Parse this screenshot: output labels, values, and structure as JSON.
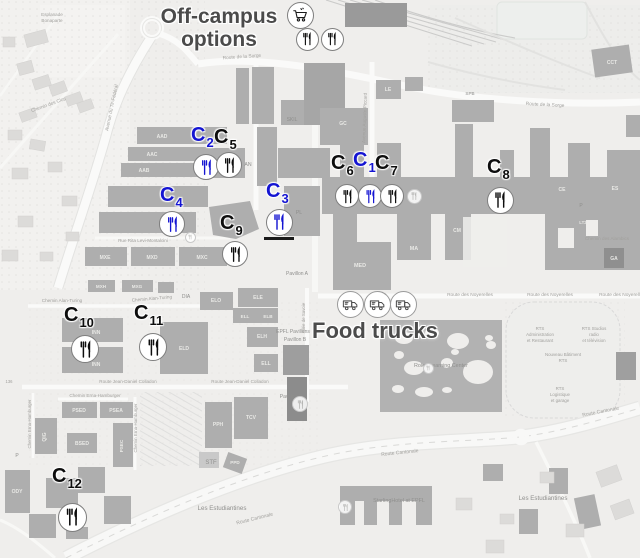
{
  "figure": {
    "off_campus": {
      "line1": "Off-campus",
      "line2": "options"
    },
    "food_trucks_label": "Food trucks",
    "colors": {
      "blue": "#1414d2",
      "black": "#0d0d0d",
      "heading": "#4b4b4b"
    },
    "c_markers": [
      {
        "label": "C",
        "sub": "1",
        "color": "blue",
        "lx": 353,
        "ly": 150,
        "cx": 370,
        "cy": 196,
        "d": 24
      },
      {
        "label": "C",
        "sub": "2",
        "color": "blue",
        "lx": 191,
        "ly": 125,
        "cx": 206,
        "cy": 167,
        "d": 26
      },
      {
        "label": "C",
        "sub": "3",
        "color": "blue",
        "lx": 266,
        "ly": 181,
        "cx": 279,
        "cy": 222,
        "d": 27,
        "underline": true
      },
      {
        "label": "C",
        "sub": "4",
        "color": "blue",
        "lx": 160,
        "ly": 185,
        "cx": 172,
        "cy": 224,
        "d": 26
      },
      {
        "label": "C",
        "sub": "5",
        "color": "black",
        "lx": 214,
        "ly": 127,
        "cx": 229,
        "cy": 165,
        "d": 26
      },
      {
        "label": "C",
        "sub": "6",
        "color": "black",
        "lx": 331,
        "ly": 153,
        "cx": 347,
        "cy": 196,
        "d": 24
      },
      {
        "label": "C",
        "sub": "7",
        "color": "black",
        "lx": 375,
        "ly": 153,
        "cx": 392,
        "cy": 196,
        "d": 24
      },
      {
        "label": "C",
        "sub": "8",
        "color": "black",
        "lx": 487,
        "ly": 157,
        "cx": 500,
        "cy": 200,
        "d": 27
      },
      {
        "label": "C",
        "sub": "9",
        "color": "black",
        "lx": 220,
        "ly": 213,
        "cx": 235,
        "cy": 254,
        "d": 26
      },
      {
        "label": "C",
        "sub": "10",
        "color": "black",
        "lx": 64,
        "ly": 305,
        "cx": 85,
        "cy": 349,
        "d": 28
      },
      {
        "label": "C",
        "sub": "11",
        "color": "black",
        "lx": 134,
        "ly": 303,
        "cx": 153,
        "cy": 347,
        "d": 28
      },
      {
        "label": "C",
        "sub": "12",
        "color": "black",
        "lx": 52,
        "ly": 466,
        "cx": 72,
        "cy": 517,
        "d": 29
      }
    ],
    "off_campus_markers": {
      "cart": {
        "x": 300,
        "y": 15,
        "d": 27
      },
      "forks": [
        {
          "x": 307,
          "y": 39,
          "d": 23
        },
        {
          "x": 332,
          "y": 39,
          "d": 23
        }
      ]
    },
    "food_trucks": [
      {
        "x": 350,
        "y": 304,
        "d": 27
      },
      {
        "x": 377,
        "y": 304,
        "d": 27
      },
      {
        "x": 403,
        "y": 304,
        "d": 27
      }
    ],
    "faint_pois": [
      {
        "x": 414,
        "y": 196,
        "d": 15
      },
      {
        "x": 300,
        "y": 404,
        "d": 16
      },
      {
        "x": 345,
        "y": 507,
        "d": 14
      },
      {
        "x": 428,
        "y": 368,
        "d": 11
      },
      {
        "x": 190,
        "y": 237,
        "d": 11
      }
    ],
    "map_labels": [
      {
        "t": "Esplanade",
        "x": 52,
        "y": 16,
        "s": 4.6,
        "c": "road"
      },
      {
        "t": "Bonaparte",
        "x": 52,
        "y": 22,
        "s": 4.6,
        "c": "road"
      },
      {
        "t": "Chemin des Clos",
        "x": 49,
        "y": 106,
        "s": 4.8,
        "c": "road",
        "r": -20
      },
      {
        "t": "Avenue du Tir-Fédéral",
        "x": 113,
        "y": 108,
        "s": 4.8,
        "c": "road",
        "r": -78
      },
      {
        "t": "Route de la Sorge",
        "x": 242,
        "y": 58,
        "s": 4.8,
        "c": "road",
        "r": -4
      },
      {
        "t": "Route de la Sorge",
        "x": 545,
        "y": 106,
        "s": 4.8,
        "c": "road",
        "r": 3
      },
      {
        "t": "Avenue Auguste-Piccard",
        "x": 366,
        "y": 118,
        "s": 4.6,
        "c": "road",
        "r": -88
      },
      {
        "t": "Rue Rita Levi-Montalcini",
        "x": 143,
        "y": 242,
        "s": 4.6,
        "c": "road"
      },
      {
        "t": "Chemin Alan-Turing",
        "x": 62,
        "y": 302,
        "s": 4.6,
        "c": "road"
      },
      {
        "t": "Chemin Alan-Turing",
        "x": 152,
        "y": 300,
        "s": 4.6,
        "c": "road",
        "r": -5
      },
      {
        "t": "Route Jean-Daniel Colladon",
        "x": 128,
        "y": 383,
        "s": 4.6,
        "c": "road"
      },
      {
        "t": "Route Jean-Daniel Colladon",
        "x": 240,
        "y": 383,
        "s": 4.6,
        "c": "road"
      },
      {
        "t": "Chemin Erna-Hamburger",
        "x": 95,
        "y": 397,
        "s": 4.6,
        "c": "road"
      },
      {
        "t": "Chemin Erna-Hamburger",
        "x": 31,
        "y": 424,
        "s": 4.4,
        "c": "road",
        "r": -90
      },
      {
        "t": "Chemin Erna-Hamburger",
        "x": 137,
        "y": 428,
        "s": 4.4,
        "c": "road",
        "r": -90
      },
      {
        "t": "Allée de Savoie",
        "x": 305,
        "y": 318,
        "s": 4.4,
        "c": "road",
        "r": -90
      },
      {
        "t": "Route des Noyerelles",
        "x": 470,
        "y": 296,
        "s": 4.8,
        "c": "road"
      },
      {
        "t": "Route des Noyerelles",
        "x": 550,
        "y": 296,
        "s": 4.8,
        "c": "road"
      },
      {
        "t": "Route des Noyerelles",
        "x": 622,
        "y": 296,
        "s": 4.8,
        "c": "road"
      },
      {
        "t": "Route Cantonale",
        "x": 255,
        "y": 520,
        "s": 5,
        "c": "road",
        "r": -14
      },
      {
        "t": "Route Cantonale",
        "x": 400,
        "y": 454,
        "s": 5,
        "c": "road",
        "r": -6
      },
      {
        "t": "Route Cantonale",
        "x": 601,
        "y": 413,
        "s": 5,
        "c": "road",
        "r": -11
      },
      {
        "t": "Chemin des Alambics",
        "x": 607,
        "y": 240,
        "s": 4.6,
        "c": "road"
      },
      {
        "t": "Les Estudiantines",
        "x": 222,
        "y": 510,
        "s": 6.2,
        "c": "dark"
      },
      {
        "t": "Les Estudiantines",
        "x": 543,
        "y": 500,
        "s": 6.2,
        "c": "dark"
      },
      {
        "t": "StarlingHotel at EPFL",
        "x": 399,
        "y": 502,
        "s": 5.4,
        "c": "dark"
      },
      {
        "t": "Rolex Learning Center",
        "x": 441,
        "y": 367,
        "s": 5.4,
        "c": "dark"
      },
      {
        "t": "EPFL Pavilions",
        "x": 293,
        "y": 333,
        "s": 5,
        "c": "dark"
      },
      {
        "t": "Pavillon B",
        "x": 295,
        "y": 341,
        "s": 5,
        "c": "dark"
      },
      {
        "t": "Pavillon A",
        "x": 297,
        "y": 275,
        "s": 5,
        "c": "dark"
      },
      {
        "t": "Pavillon C",
        "x": 291,
        "y": 398,
        "s": 5,
        "c": "dark"
      },
      {
        "t": "DIA",
        "x": 186,
        "y": 298,
        "s": 5,
        "c": "dark"
      },
      {
        "t": "STF",
        "x": 211,
        "y": 464,
        "s": 6,
        "c": "dark"
      },
      {
        "t": "SKIL",
        "x": 292,
        "y": 121,
        "s": 5,
        "c": "dark"
      },
      {
        "t": "AN",
        "x": 248,
        "y": 166,
        "s": 5.2,
        "c": "dark"
      },
      {
        "t": "PL",
        "x": 299,
        "y": 214,
        "s": 5.2,
        "c": "dark"
      },
      {
        "t": "SPB",
        "x": 470,
        "y": 95,
        "s": 4.6,
        "c": "dark"
      },
      {
        "t": "P",
        "x": 17,
        "y": 457,
        "s": 5,
        "c": "dark"
      },
      {
        "t": "P",
        "x": 581,
        "y": 207,
        "s": 5,
        "c": "dark"
      },
      {
        "t": "136",
        "x": 9,
        "y": 383,
        "s": 4.2,
        "c": "road"
      },
      {
        "t": "AAD",
        "x": 162,
        "y": 138,
        "s": 5,
        "c": "bldg"
      },
      {
        "t": "AAC",
        "x": 152,
        "y": 156,
        "s": 5,
        "c": "bldg"
      },
      {
        "t": "AAB",
        "x": 144,
        "y": 172,
        "s": 5,
        "c": "bldg"
      },
      {
        "t": "MXE",
        "x": 105,
        "y": 259,
        "s": 5,
        "c": "bldg"
      },
      {
        "t": "MXD",
        "x": 152,
        "y": 259,
        "s": 5,
        "c": "bldg"
      },
      {
        "t": "MXC",
        "x": 202,
        "y": 259,
        "s": 5,
        "c": "bldg"
      },
      {
        "t": "MXH",
        "x": 101,
        "y": 288,
        "s": 4.6,
        "c": "bldg"
      },
      {
        "t": "MXG",
        "x": 137,
        "y": 288,
        "s": 4.6,
        "c": "bldg"
      },
      {
        "t": "INN",
        "x": 96,
        "y": 334,
        "s": 5,
        "c": "bldg"
      },
      {
        "t": "INN",
        "x": 96,
        "y": 366,
        "s": 5,
        "c": "bldg"
      },
      {
        "t": "ELD",
        "x": 184,
        "y": 350,
        "s": 5,
        "c": "bldg"
      },
      {
        "t": "ELO",
        "x": 216,
        "y": 302,
        "s": 5,
        "c": "bldg"
      },
      {
        "t": "ELE",
        "x": 258,
        "y": 299,
        "s": 5,
        "c": "bldg"
      },
      {
        "t": "ELL",
        "x": 245,
        "y": 318,
        "s": 4.6,
        "c": "bldg"
      },
      {
        "t": "ELB",
        "x": 268,
        "y": 318,
        "s": 4.6,
        "c": "bldg"
      },
      {
        "t": "ELH",
        "x": 262,
        "y": 338,
        "s": 5,
        "c": "bldg"
      },
      {
        "t": "ELL",
        "x": 266,
        "y": 365,
        "s": 5,
        "c": "bldg"
      },
      {
        "t": "MED",
        "x": 360,
        "y": 267,
        "s": 5.4,
        "c": "bldg"
      },
      {
        "t": "MA",
        "x": 414,
        "y": 250,
        "s": 5.4,
        "c": "bldg"
      },
      {
        "t": "CE",
        "x": 562,
        "y": 191,
        "s": 5,
        "c": "bldg"
      },
      {
        "t": "ES",
        "x": 615,
        "y": 190,
        "s": 5,
        "c": "bldg"
      },
      {
        "t": "GA",
        "x": 614,
        "y": 260,
        "s": 5,
        "c": "bldg"
      },
      {
        "t": "CM",
        "x": 457,
        "y": 232,
        "s": 5,
        "c": "bldg"
      },
      {
        "t": "GC",
        "x": 343,
        "y": 125,
        "s": 5,
        "c": "bldg"
      },
      {
        "t": "LE",
        "x": 388,
        "y": 91,
        "s": 5,
        "c": "bldg"
      },
      {
        "t": "CCT",
        "x": 612,
        "y": 64,
        "s": 5,
        "c": "bldg"
      },
      {
        "t": "QIG",
        "x": 46,
        "y": 437,
        "s": 5,
        "c": "bldg",
        "r": -90
      },
      {
        "t": "PSED",
        "x": 79,
        "y": 412,
        "s": 5,
        "c": "bldg"
      },
      {
        "t": "PSEA",
        "x": 116,
        "y": 412,
        "s": 5,
        "c": "bldg"
      },
      {
        "t": "BSED",
        "x": 82,
        "y": 445,
        "s": 5,
        "c": "bldg"
      },
      {
        "t": "PSEC",
        "x": 123,
        "y": 446,
        "s": 4.6,
        "c": "bldg",
        "r": -90
      },
      {
        "t": "ODY",
        "x": 17,
        "y": 493,
        "s": 5,
        "c": "bldg"
      },
      {
        "t": "PPH",
        "x": 218,
        "y": 426,
        "s": 5,
        "c": "bldg"
      },
      {
        "t": "TCV",
        "x": 251,
        "y": 419,
        "s": 5,
        "c": "bldg"
      },
      {
        "t": "PPD",
        "x": 235,
        "y": 464,
        "s": 4.6,
        "c": "bldg"
      },
      {
        "t": "LT2",
        "x": 583,
        "y": 224,
        "s": 4.4,
        "c": "bldg"
      },
      {
        "t": "RTS",
        "x": 540,
        "y": 330,
        "s": 4.4,
        "c": "road"
      },
      {
        "t": "Administration",
        "x": 540,
        "y": 336,
        "s": 4.4,
        "c": "road"
      },
      {
        "t": "et Restaurant",
        "x": 540,
        "y": 342,
        "s": 4.4,
        "c": "road"
      },
      {
        "t": "RTS Studios",
        "x": 594,
        "y": 330,
        "s": 4.4,
        "c": "road"
      },
      {
        "t": "radio",
        "x": 594,
        "y": 336,
        "s": 4.4,
        "c": "road"
      },
      {
        "t": "et télévision",
        "x": 594,
        "y": 342,
        "s": 4.4,
        "c": "road"
      },
      {
        "t": "Nouveau Bâtiment",
        "x": 563,
        "y": 356,
        "s": 4.4,
        "c": "road"
      },
      {
        "t": "RTS",
        "x": 563,
        "y": 362,
        "s": 4.4,
        "c": "road"
      },
      {
        "t": "RTS",
        "x": 560,
        "y": 390,
        "s": 4.4,
        "c": "road"
      },
      {
        "t": "Logistique",
        "x": 560,
        "y": 396,
        "s": 4.4,
        "c": "road"
      },
      {
        "t": "et garage",
        "x": 560,
        "y": 402,
        "s": 4.4,
        "c": "road"
      }
    ]
  }
}
